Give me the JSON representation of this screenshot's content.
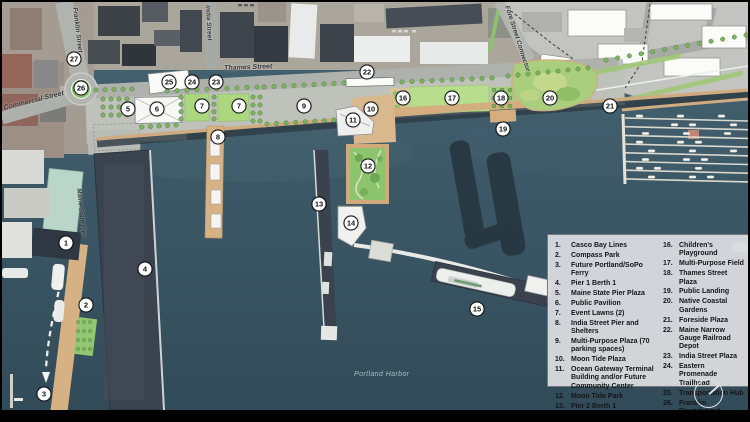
{
  "street_labels": [
    {
      "id": "thames",
      "text": "Thames Street",
      "x": 222,
      "y": 63,
      "rot": -2
    },
    {
      "id": "commercial",
      "text": "Commercial Street",
      "x": 1,
      "y": 103,
      "rot": -14
    },
    {
      "id": "franklin",
      "text": "Franklin Street",
      "x": 76,
      "y": 5,
      "rot": 83
    },
    {
      "id": "india",
      "text": "India Street",
      "x": 209,
      "y": 3,
      "rot": 87
    },
    {
      "id": "fore",
      "text": "Fore Street Connector",
      "x": 508,
      "y": 3,
      "rot": 72
    },
    {
      "id": "maine_state_pier",
      "text": "Maine State Pier",
      "x": 80,
      "y": 186,
      "rot": 84
    },
    {
      "id": "harbor",
      "text": "Portland Harbor",
      "x": 352,
      "y": 369,
      "rot": 0
    }
  ],
  "markers": [
    {
      "n": "1",
      "x": 64,
      "y": 241
    },
    {
      "n": "2",
      "x": 84,
      "y": 303
    },
    {
      "n": "3",
      "x": 42,
      "y": 392
    },
    {
      "n": "4",
      "x": 143,
      "y": 267
    },
    {
      "n": "5",
      "x": 126,
      "y": 107
    },
    {
      "n": "6",
      "x": 155,
      "y": 107
    },
    {
      "n": "7",
      "x": 200,
      "y": 104
    },
    {
      "n": "7",
      "x": 237,
      "y": 104
    },
    {
      "n": "8",
      "x": 216,
      "y": 135
    },
    {
      "n": "9",
      "x": 302,
      "y": 104
    },
    {
      "n": "10",
      "x": 369,
      "y": 107
    },
    {
      "n": "11",
      "x": 351,
      "y": 118
    },
    {
      "n": "12",
      "x": 366,
      "y": 164
    },
    {
      "n": "13",
      "x": 317,
      "y": 202
    },
    {
      "n": "14",
      "x": 349,
      "y": 221
    },
    {
      "n": "15",
      "x": 475,
      "y": 307
    },
    {
      "n": "16",
      "x": 401,
      "y": 96
    },
    {
      "n": "17",
      "x": 450,
      "y": 96
    },
    {
      "n": "18",
      "x": 499,
      "y": 96
    },
    {
      "n": "19",
      "x": 501,
      "y": 127
    },
    {
      "n": "20",
      "x": 548,
      "y": 96
    },
    {
      "n": "21",
      "x": 608,
      "y": 104
    },
    {
      "n": "22",
      "x": 365,
      "y": 70
    },
    {
      "n": "23",
      "x": 214,
      "y": 80
    },
    {
      "n": "24",
      "x": 190,
      "y": 80
    },
    {
      "n": "25",
      "x": 167,
      "y": 80
    },
    {
      "n": "26",
      "x": 79,
      "y": 86
    },
    {
      "n": "27",
      "x": 72,
      "y": 57
    }
  ],
  "legend": {
    "column1": [
      {
        "num": "1.",
        "text": "Casco Bay Lines"
      },
      {
        "num": "2.",
        "text": "Compass Park"
      },
      {
        "num": "3.",
        "text": "Future Portland/SoPo Ferry"
      },
      {
        "num": "4.",
        "text": "Pier 1 Berth 1"
      },
      {
        "num": "5.",
        "text": "Maine State Pier Plaza"
      },
      {
        "num": "6.",
        "text": "Public Pavilion"
      },
      {
        "num": "7.",
        "text": "Event Lawns (2)"
      },
      {
        "num": "8.",
        "text": "India Street Pier and Shelters"
      },
      {
        "num": "9.",
        "text": "Multi-Purpose Plaza (70 parking spaces)"
      },
      {
        "num": "10.",
        "text": "Moon Tide Plaza"
      },
      {
        "num": "11.",
        "text": "Ocean Gateway Terminal Building and/or Future Community Center"
      },
      {
        "num": "12.",
        "text": "Moon Tide Park"
      },
      {
        "num": "13.",
        "text": "Pier 2 Berth 1"
      },
      {
        "num": "14.",
        "text": "Ocean Gateway Receiving Station"
      },
      {
        "num": "15.",
        "text": "Pier 2 Birth 2"
      }
    ],
    "column2": [
      {
        "num": "16.",
        "text": "Children's Playground"
      },
      {
        "num": "17.",
        "text": "Multi-Purpose Field"
      },
      {
        "num": "18.",
        "text": "Thames Street Plaza"
      },
      {
        "num": "19.",
        "text": "Public Landing"
      },
      {
        "num": "20.",
        "text": "Native Coastal Gardens"
      },
      {
        "num": "21.",
        "text": "Foreside Plaza"
      },
      {
        "num": "22.",
        "text": "Maine Narrow Gauge Railroad Depot"
      },
      {
        "num": "23.",
        "text": "India Street Plaza"
      },
      {
        "num": "24.",
        "text": "Eastern Promenade Trailhead"
      },
      {
        "num": "25.",
        "text": "Transportation Hub"
      },
      {
        "num": "26.",
        "text": "Franklin Roundabout"
      },
      {
        "num": "27.",
        "text": "Franklin Street Pedestrian and Bike Improvements"
      }
    ]
  },
  "colors": {
    "water": "#3e5c6b",
    "lawn": "#abd77f",
    "field": "#b7dd8d",
    "gardens": "#a9ce7e",
    "tan": "#d6b183",
    "hardscape": "#bfc1bb",
    "street": "#aeb1ac",
    "dark_pier": "#3a434e",
    "legend_bg": "#d7dbde",
    "marker_bg": "#ffffff",
    "roundabout_green": "#87bf70"
  }
}
